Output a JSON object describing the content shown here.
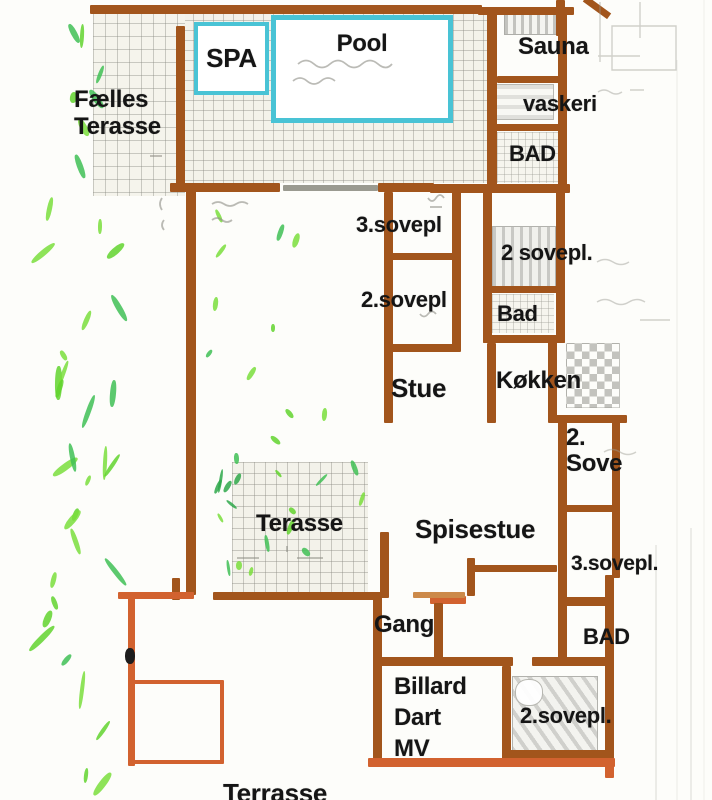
{
  "colors": {
    "wall_brown": "#a2551c",
    "wall_orange": "#d2622f",
    "wall_light": "#cc8a4a",
    "wall_pencil": "#9a9a90",
    "pool_cyan": "#49c3d5",
    "label_black": "#151515",
    "tile_gray": "#8a8a82",
    "plant_greens": [
      "#62d32e",
      "#3fbf55",
      "#7ade3c",
      "#2ea84a"
    ]
  },
  "rooms": {
    "faelles_terasse": {
      "label_line1": "Fælles",
      "label_line2": "Terasse"
    },
    "spa": {
      "label": "SPA"
    },
    "pool": {
      "label": "Pool"
    },
    "sauna": {
      "label": "Sauna"
    },
    "vaskeri": {
      "label": "vaskeri"
    },
    "bad_top": {
      "label": "BAD"
    },
    "sovepl3_mid": {
      "label": "3.sovepl"
    },
    "sovepl2_mid": {
      "label": "2.sovepl"
    },
    "sovepl2_right": {
      "label": "2 sovepl."
    },
    "bad_right": {
      "label": "Bad"
    },
    "stue": {
      "label": "Stue"
    },
    "koekken": {
      "label": "Køkken"
    },
    "sove2": {
      "label_line1": "2.",
      "label_line2": "Sove"
    },
    "spisestue": {
      "label": "Spisestue"
    },
    "sovepl3_low": {
      "label": "3.sovepl."
    },
    "gang": {
      "label": "Gang"
    },
    "bad_low": {
      "label": "BAD"
    },
    "billard": {
      "label_line1": "Billard",
      "label_line2": "Dart",
      "label_line3": "MV"
    },
    "sovepl2_low": {
      "label": "2.sovepl."
    },
    "terasse_mid": {
      "label": "Terasse"
    },
    "terrasse_bottom": {
      "label": "Terrasse"
    }
  }
}
